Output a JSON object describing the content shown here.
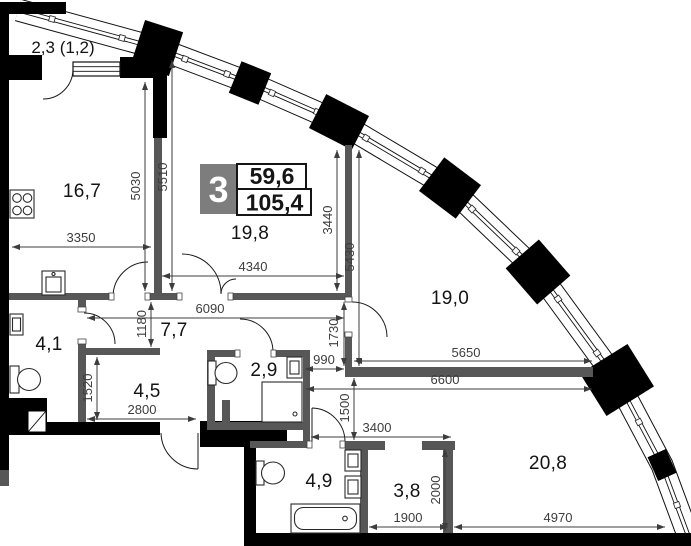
{
  "badge": {
    "room_count": "3",
    "living_area": "59,6",
    "total_area": "105,4"
  },
  "rooms": {
    "balcony": "2,3 (1,2)",
    "kitchen": "16,7",
    "living_room": "19,8",
    "bedroom": "19,0",
    "bathroom_small": "4,1",
    "corridor": "7,7",
    "hall": "4,5",
    "shower_room": "2,9",
    "bathroom": "4,9",
    "storage": "3,8",
    "bedroom2": "20,8"
  },
  "dimensions": {
    "d3350": "3350",
    "d5030": "5030",
    "d5510": "5510",
    "d4340": "4340",
    "d3440": "3440",
    "d5430": "5430",
    "d6090": "6090",
    "d1180": "1180",
    "d1730": "1730",
    "d990": "990",
    "d5650": "5650",
    "d6600": "6600",
    "d1520": "1520",
    "d2800": "2800",
    "d1500": "1500",
    "d3400": "3400",
    "d1900": "1900",
    "d2000": "2000",
    "d4970": "4970"
  },
  "colors": {
    "wall_exterior": "#000000",
    "wall_interior": "#575757",
    "dimension_text": "#3d3d3d",
    "room_label": "#141414",
    "badge_background": "#7d7d7d"
  }
}
